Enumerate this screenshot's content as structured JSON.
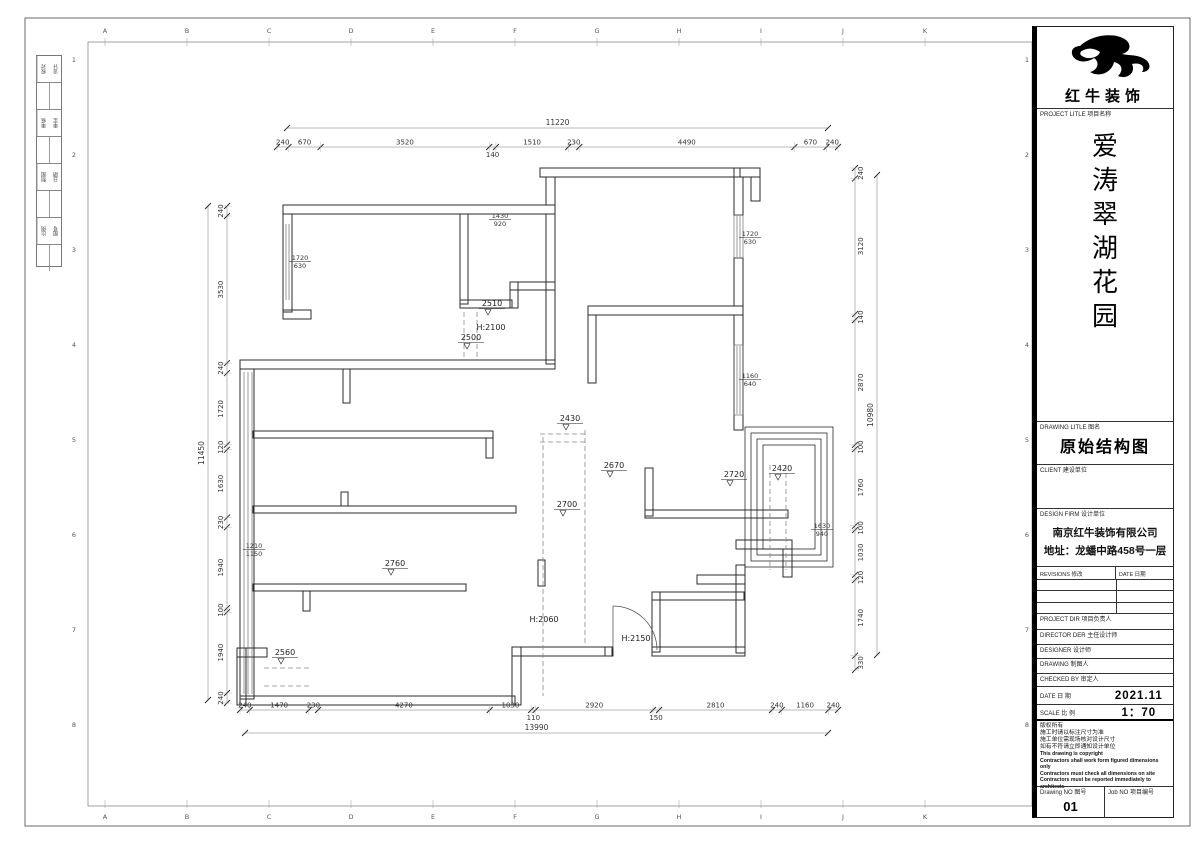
{
  "grid": {
    "letters": [
      "A",
      "B",
      "C",
      "D",
      "E",
      "F",
      "G",
      "H",
      "I",
      "J",
      "K"
    ],
    "numbers": [
      "1",
      "2",
      "3",
      "4",
      "5",
      "6",
      "7",
      "8"
    ]
  },
  "signoff": {
    "pairs": [
      [
        "校对",
        "设计"
      ],
      [
        "审核",
        "审定"
      ],
      [
        "制图",
        "日期"
      ],
      [
        "比例",
        "图号"
      ]
    ]
  },
  "plan": {
    "chains": [
      {
        "name": "top-dim-chain",
        "orient": "h",
        "x0": 277,
        "x1": 838,
        "y": 147,
        "dims": [
          240,
          670,
          3520,
          140,
          1510,
          230,
          4490,
          670,
          240
        ]
      },
      {
        "name": "bottom-dim-chain",
        "orient": "h",
        "x0": 240,
        "x1": 838,
        "y": 710,
        "dims": [
          240,
          1470,
          230,
          4270,
          1030,
          110,
          2920,
          150,
          2810,
          240,
          1160,
          240
        ]
      },
      {
        "name": "left-dim-chain",
        "orient": "v",
        "x": 227,
        "y0": 206,
        "y1": 703,
        "side": "l",
        "dims": [
          240,
          3530,
          240,
          1720,
          120,
          1630,
          230,
          1940,
          100,
          1940,
          240
        ]
      },
      {
        "name": "right-dim-chain",
        "orient": "v",
        "x": 855,
        "y0": 168,
        "y1": 670,
        "side": "r",
        "dims": [
          240,
          3120,
          140,
          2870,
          100,
          1760,
          100,
          1030,
          120,
          1740,
          330
        ]
      }
    ],
    "totals": [
      {
        "name": "top-overall-dim",
        "orient": "h",
        "x0": 287,
        "x1": 828,
        "y": 128,
        "text": "11220"
      },
      {
        "name": "bottom-overall-dim",
        "orient": "h",
        "x0": 245,
        "x1": 828,
        "y": 733,
        "text": "13990"
      },
      {
        "name": "left-overall-dim",
        "orient": "v",
        "x": 208,
        "y0": 206,
        "y1": 700,
        "text": "11450"
      },
      {
        "name": "right-overall-dim",
        "orient": "v",
        "x": 877,
        "y0": 175,
        "y1": 655,
        "text": "10980"
      }
    ],
    "levels": [
      {
        "t": "2510",
        "x": 492,
        "y": 306
      },
      {
        "t": "2500",
        "x": 471,
        "y": 340
      },
      {
        "t": "2430",
        "x": 570,
        "y": 421
      },
      {
        "t": "2670",
        "x": 614,
        "y": 468
      },
      {
        "t": "2720",
        "x": 734,
        "y": 477
      },
      {
        "t": "2420",
        "x": 782,
        "y": 471
      },
      {
        "t": "2700",
        "x": 567,
        "y": 507
      },
      {
        "t": "2760",
        "x": 395,
        "y": 566
      },
      {
        "t": "2560",
        "x": 285,
        "y": 655
      }
    ],
    "heights": [
      {
        "t": "H:2100",
        "x": 491,
        "y": 330
      },
      {
        "t": "H:2060",
        "x": 544,
        "y": 622
      },
      {
        "t": "H:2150",
        "x": 636,
        "y": 641
      }
    ],
    "windows": [
      {
        "top": "1720",
        "bot": "630",
        "x": 300,
        "y": 260
      },
      {
        "top": "1430",
        "bot": "920",
        "x": 500,
        "y": 218
      },
      {
        "top": "1720",
        "bot": "630",
        "x": 750,
        "y": 236
      },
      {
        "top": "1160",
        "bot": "640",
        "x": 750,
        "y": 378
      },
      {
        "top": "1630",
        "bot": "940",
        "x": 822,
        "y": 528
      },
      {
        "top": "1210",
        "bot": "1150",
        "x": 254,
        "y": 548
      }
    ]
  },
  "titleblock": {
    "brand": "红牛装饰",
    "project_label": "PROJECT LITLE   项目名称",
    "project_name_chars": [
      "爱",
      "涛",
      "翠",
      "湖",
      "花",
      "园"
    ],
    "drawing_label": "DRAWING LITLE   图名",
    "drawing_title": "原始结构图",
    "client_label": "CLIENT   建设单位",
    "firm_label": "DESIGN FIRM   设计单位",
    "firm_name": "南京红牛装饰有限公司",
    "firm_addr": "地址：龙蟠中路458号一层",
    "revisions_label": "REVISIONS   修改",
    "date_col_label": "DATE   日期",
    "rows": [
      {
        "label": "PROJECT DIR     项目负责人"
      },
      {
        "label": "DIRECTOR DER   主任设计师"
      },
      {
        "label": "DESIGNER         设计师"
      },
      {
        "label": "DRAWING          制图人"
      },
      {
        "label": "CHECKED BY     审定人"
      }
    ],
    "date_label": "DATE          日  期",
    "date_value": "2021.11",
    "scale_label": "SCALE         比  例",
    "scale_value": "1：70",
    "notes": [
      "版权所有",
      "施工时请以标注尺寸为准",
      "施工单位需现场核对设计尺寸",
      "如有不符请立即通知设计单位",
      "This drawing is copyright",
      "Contractors shall work form figured dimensions only",
      "Contractors must check all dimensions on site",
      "Contractors must be reported immediately to architects"
    ],
    "drawing_no_label": "Drawing NO   图号",
    "drawing_no": "01",
    "job_no_label": "Job NO   项目编号"
  }
}
